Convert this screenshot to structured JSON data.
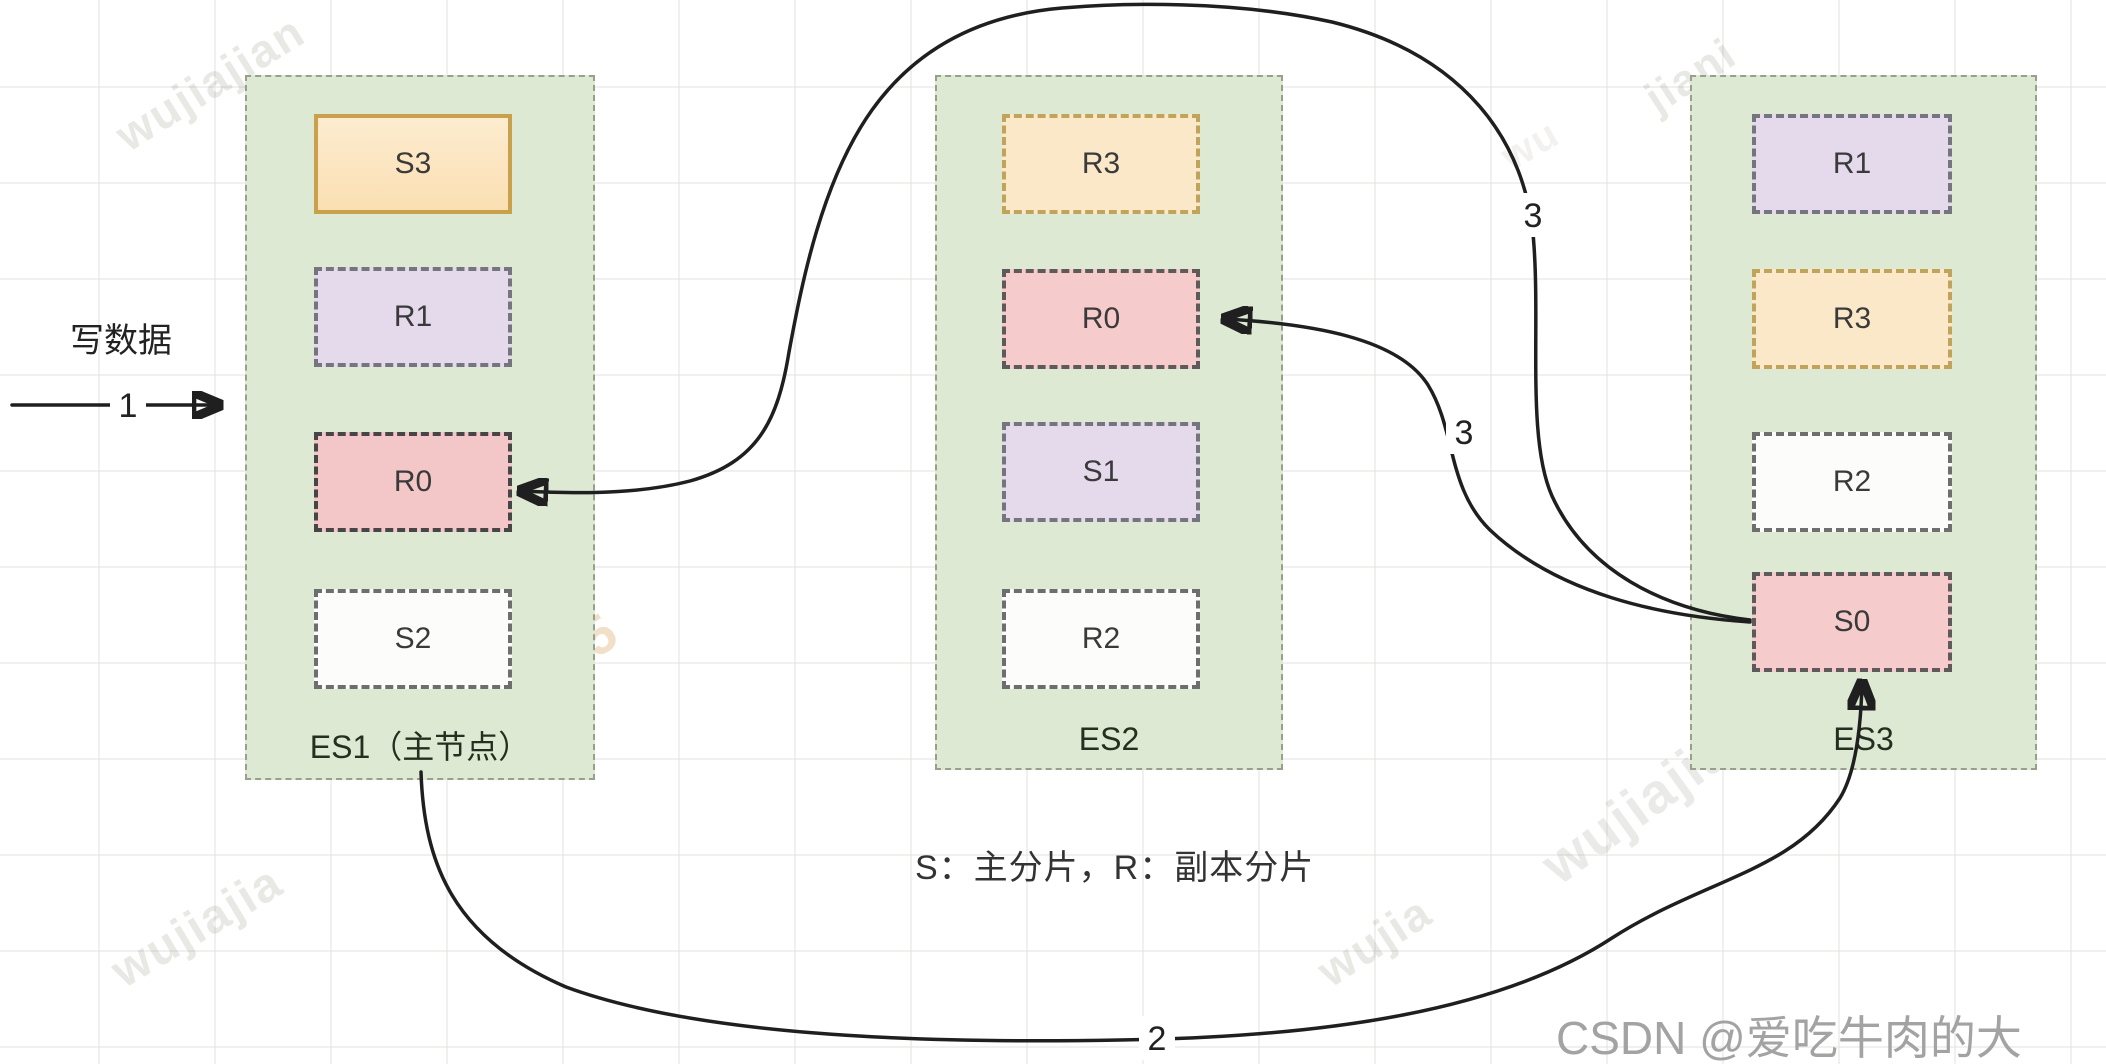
{
  "diagram": {
    "write_label": "写数据",
    "legend": "S：主分片，R：副本分片",
    "credit": "CSDN @爱吃牛肉的大",
    "steps": {
      "write": "1",
      "route": "2",
      "replicate_to_es2": "3",
      "replicate_to_es1": "3"
    },
    "nodes": [
      {
        "id": "ES1",
        "label": "ES1（主节点）",
        "shards": [
          {
            "label": "S3"
          },
          {
            "label": "R1"
          },
          {
            "label": "R0"
          },
          {
            "label": "S2"
          }
        ]
      },
      {
        "id": "ES2",
        "label": "ES2",
        "shards": [
          {
            "label": "R3"
          },
          {
            "label": "R0"
          },
          {
            "label": "S1"
          },
          {
            "label": "R2"
          }
        ]
      },
      {
        "id": "ES3",
        "label": "ES3",
        "shards": [
          {
            "label": "R1"
          },
          {
            "label": "R3"
          },
          {
            "label": "R2"
          },
          {
            "label": "S0"
          }
        ]
      }
    ],
    "watermarks": [
      {
        "text": "wujiajian"
      },
      {
        "text": "jiani"
      },
      {
        "text": "190715"
      },
      {
        "text": "wujiajiang1790715"
      },
      {
        "text": "wujiajia"
      },
      {
        "text": "wujia"
      },
      {
        "text": "wu"
      }
    ],
    "colors": {
      "node_fill": "#dde9d3",
      "primary_orange_fill": "#fbe3bd",
      "orange_border": "#c9a14d",
      "replica_purple_fill": "#e4daeb",
      "shard_pink_fill": "#f5cbcb",
      "shard_white_fill": "#fcfcfa",
      "arrow": "#1f1f1f",
      "credit_gray": "#a3a3a3"
    }
  }
}
